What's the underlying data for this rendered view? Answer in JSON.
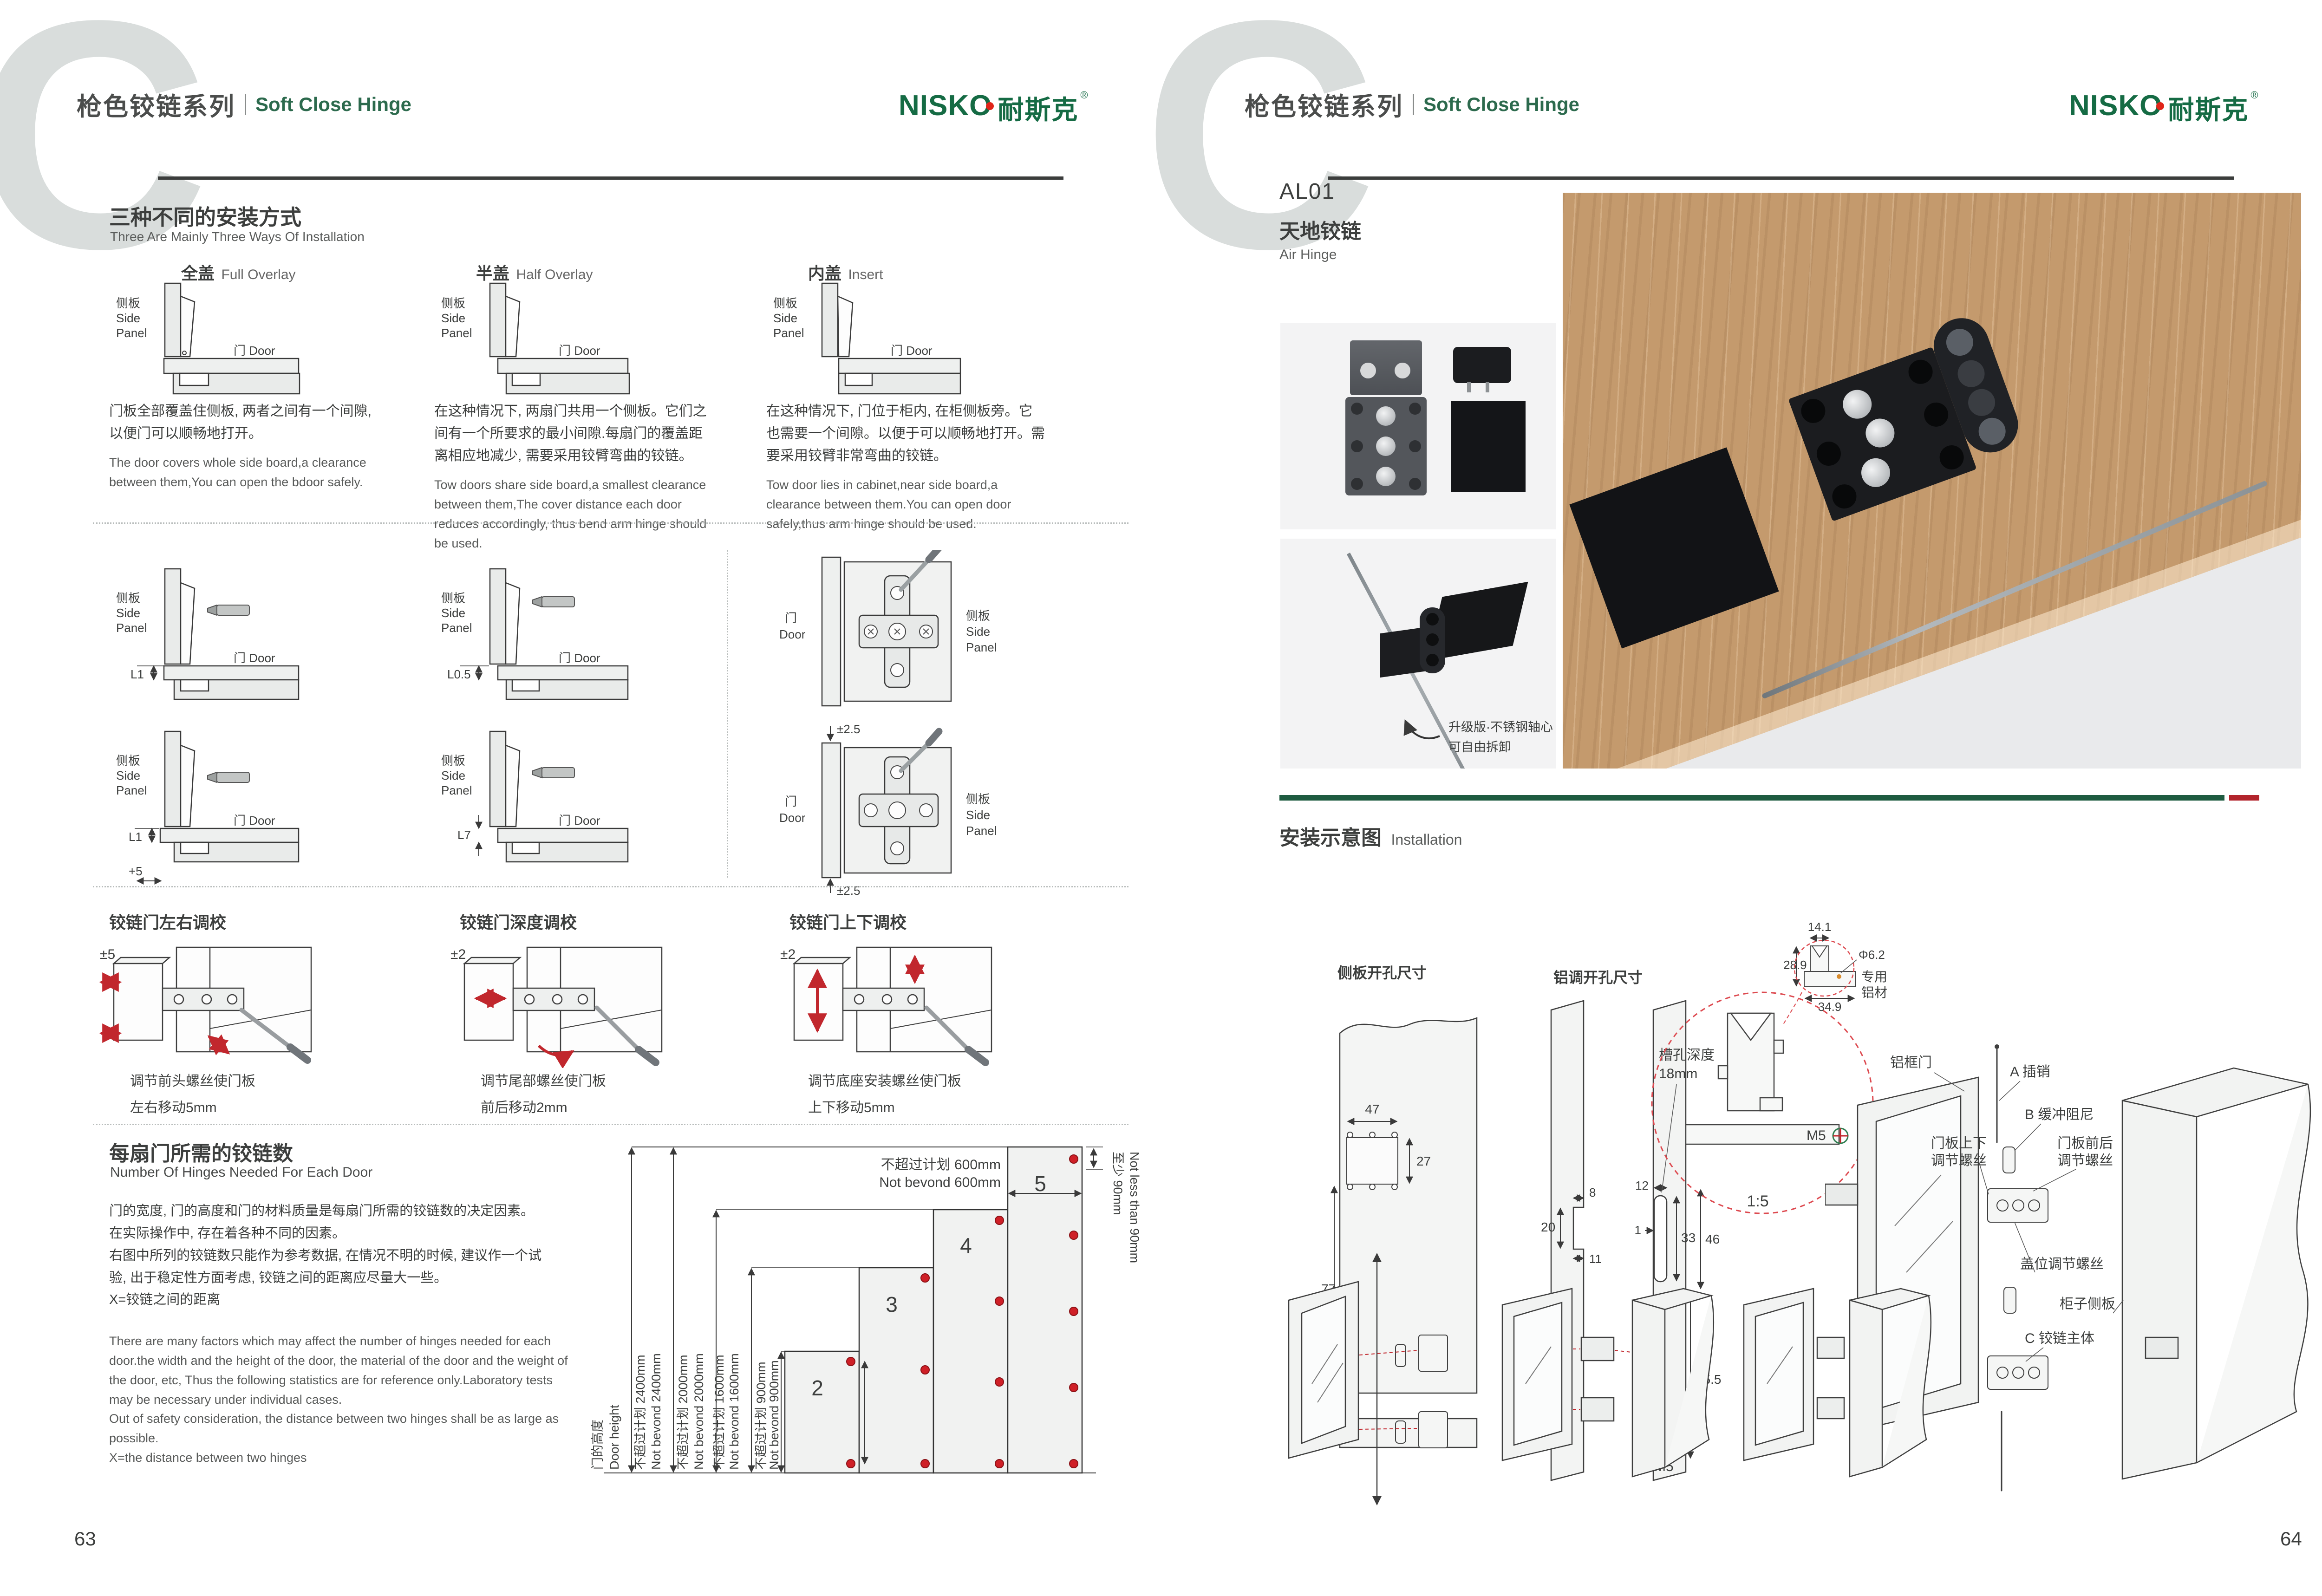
{
  "shared": {
    "series_cn": "枪色铰链系列",
    "series_en": "Soft Close Hinge",
    "watermark": "C",
    "logo_en": "NISKO",
    "logo_cn": "耐斯克",
    "logo_reg": "®",
    "lbl_panel_cn": "侧板",
    "lbl_side": "Side",
    "lbl_panel": "Panel",
    "lbl_door": "门 Door",
    "lbl_door_cn": "门",
    "lbl_door_en": "Door"
  },
  "left": {
    "page": "63",
    "s1": {
      "title_cn": "三种不同的安装方式",
      "title_en": "Three Are Mainly Three Ways Of Installation",
      "columns": [
        {
          "type_cn": "全盖",
          "type_en": "Full Overlay",
          "desc_cn": "门板全部覆盖住侧板, 两者之间有一个间隙, 以便门可以顺畅地打开。",
          "desc_en": "The door covers whole side board,a clearance between them,You can open the bdoor safely."
        },
        {
          "type_cn": "半盖",
          "type_en": "Half Overlay",
          "desc_cn": "在这种情况下, 两扇门共用一个侧板。它们之间有一个所要求的最小间隙.每扇门的覆盖距离相应地减少, 需要采用铰臂弯曲的铰链。",
          "desc_en": "Tow doors share side board,a smallest clearance between them,The cover distance each door reduces accordingly, thus bend arm hinge should be used."
        },
        {
          "type_cn": "内盖",
          "type_en": "Insert",
          "desc_cn": "在这种情况下, 门位于柜内, 在柜侧板旁。它也需要一个间隙。以便于可以顺畅地打开。需要采用铰臂非常弯曲的铰链。",
          "desc_en": "Tow door lies in cabinet,near side board,a clearance between them.You can open door safely,thus arm hinge should be used."
        }
      ]
    },
    "s2": {
      "r1c1": "L1",
      "r1c2": "L0.5",
      "r2c1": "L1",
      "r2c1b": "+5",
      "r2c2": "L7",
      "pm": "±2.5"
    },
    "s3": {
      "items": [
        {
          "title": "铰链门左右调校",
          "dim": "±5",
          "cap1": "调节前头螺丝使门板",
          "cap2": "左右移动5mm"
        },
        {
          "title": "铰链门深度调校",
          "dim": "±2",
          "cap1": "调节尾部螺丝使门板",
          "cap2": "前后移动2mm"
        },
        {
          "title": "铰链门上下调校",
          "dim": "±2",
          "cap1": "调节底座安装螺丝使门板",
          "cap2": "上下移动5mm"
        }
      ]
    },
    "s4": {
      "title_cn": "每扇门所需的铰链数",
      "title_en": "Number Of Hinges Needed For Each Door",
      "cn1": "门的宽度, 门的高度和门的材料质量是每扇门所需的铰链数的决定因素。",
      "cn2": "在实际操作中, 存在着各种不同的因素。",
      "cn3": "右图中所列的铰链数只能作为参考数据, 在情况不明的时候, 建议作一个试验, 出于稳定性方面考虑, 铰链之间的距离应尽量大一些。",
      "cn4": "X=铰链之间的距离",
      "en1": "There are many factors which may affect the number of hinges needed for each door.the width and the height of the door, the material of the door and the weight of the door, etc, Thus the following statistics are for reference only.Laboratory tests may be necessary under individual cases.",
      "en2": "Out of safety consideration, the distance between two hinges shall be as large as possible.",
      "en3": "X=the distance between two hinges",
      "chart": {
        "dh_cn": "门的高度",
        "dh_en": "Door height",
        "h2400_cn": "不超过计划 2400mm",
        "h2400_en": "Not bevond 2400mm",
        "h2000_cn": "不超过计划 2000mm",
        "h2000_en": "Not bevond 2000mm",
        "h1600_cn": "不超过计划 1600mm",
        "h1600_en": "Not bevond 1600mm",
        "h900_cn": "不超过计划 900mm",
        "h900_en": "Not bevond 900mm",
        "w600_cn": "不超过计划 600mm",
        "w600_en": "Not bevond 600mm",
        "min_cn": "至少 90mm",
        "min_en": "Not less than 90mm",
        "n2": "2",
        "n3": "3",
        "n4": "4",
        "n5": "5"
      }
    }
  },
  "right": {
    "page": "64",
    "product": {
      "code": "AL01",
      "name_cn": "天地铰链",
      "name_en": "Air Hinge"
    },
    "note1": "升级版·不锈钢轴心",
    "note2": "可自由拆卸",
    "inst_cn": "安装示意图",
    "inst_en": "Installation",
    "dA": {
      "title": "侧板开孔尺寸",
      "d47": "47",
      "d27": "27",
      "d77": "77",
      "d25": "25"
    },
    "dB": {
      "title": "铝调开孔尺寸",
      "d8": "8",
      "d20": "20",
      "d11": "11",
      "d12": "12",
      "d1": "1",
      "d33": "33",
      "d46": "46",
      "d155": "15.5",
      "m5": "M5",
      "note1": "槽孔深度",
      "note2": "18mm"
    },
    "dC": {
      "d141": "14.1",
      "d289": "28.9",
      "d349": "34.9",
      "dia": "Φ6.2",
      "mat1": "专用",
      "mat2": "铝材"
    },
    "dD": {
      "m5": "M5",
      "scale": "1:5"
    },
    "dE": {
      "door": "铝框门",
      "pin": "A 插销",
      "damper": "B 缓冲阻尼",
      "ud1": "门板上下",
      "ud2": "调节螺丝",
      "fb1": "门板前后",
      "fb2": "调节螺丝",
      "ov": "盖位调节螺丝",
      "cab": "柜子侧板",
      "body": "C 铰链主体"
    }
  },
  "chart_data": {
    "type": "bar",
    "title": "每扇门所需的铰链数 Number Of Hinges Needed For Each Door",
    "categories": [
      "door height ≤900mm",
      "door height ≤1600mm",
      "door height ≤2000mm",
      "door height ≤2400mm"
    ],
    "values": [
      2,
      3,
      4,
      5
    ],
    "xlabel": "门的高度 Door height (不超过计划 Not bevond)",
    "ylabel": "number of hinges",
    "annotations": [
      "door width 不超过计划 600mm Not bevond 600mm",
      "top hinge distance 至少 90mm Not less than 90mm"
    ]
  }
}
